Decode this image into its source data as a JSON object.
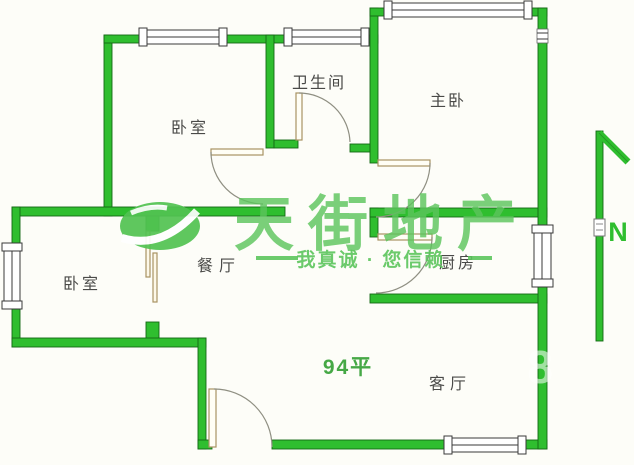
{
  "rooms": [
    {
      "key": "bedroom-top",
      "label": "卧室"
    },
    {
      "key": "bathroom",
      "label": "卫生间"
    },
    {
      "key": "master-bedroom",
      "label": "主卧"
    },
    {
      "key": "bedroom-left",
      "label": "卧室"
    },
    {
      "key": "dining",
      "label": "餐厅"
    },
    {
      "key": "kitchen",
      "label": "厨房"
    },
    {
      "key": "living",
      "label": "客厅"
    }
  ],
  "annotations": {
    "area_text": "94平",
    "north_label": "N",
    "faint_digit": "8"
  },
  "watermark": {
    "brand_name": "天街地产",
    "brand_chars": [
      "天",
      "街",
      "地",
      "产"
    ],
    "tagline": "我真诚 · 您信赖"
  },
  "icons": {
    "north_arrow": "north-arrow-icon",
    "brand_logo": "brand-logo-ellipse"
  },
  "colors": {
    "wall_green": "#2fbe2f",
    "wall_outline": "#156815",
    "watermark_green": "#5cc55c",
    "label_gray": "#4a4a48",
    "door_tan": "#a89363",
    "area_green": "#46a846",
    "background": "#fdfdf8"
  }
}
